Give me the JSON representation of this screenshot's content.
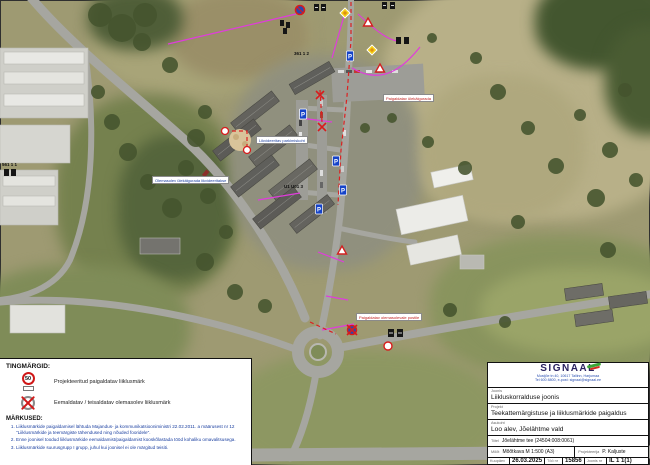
{
  "legend": {
    "heading": "TINGMÄRGID:",
    "items": [
      {
        "icon": "speed-limit-50-sign-icon",
        "sign_value": "50",
        "label": "Projekteeritud paigaldatav liiklusmärk"
      },
      {
        "icon": "removed-sign-icon",
        "label": "Eemaldatav / teisaldatav olemasolev liiklusmärk"
      }
    ],
    "notes_heading": "MÄRKUSED:",
    "notes": [
      "Liiklusmärkide paigaldamisel lähtuda Majandus- ja kommunikatsiooniministri 22.02.2011. a määrusest nr 12 \"Liiklusmärkide ja teemärgiste tähendused ning nõuded fooridele\".",
      "Enne joonisel toodud liiklusmärkide eemaldamist/paigaldamist kooskõlastada tööd kohaliku omavalitsusega.",
      "Liiklusmärkide suurusgrupp I grupp, juhul kui joonisel ei ole märgitud teisiti."
    ]
  },
  "title_block": {
    "company_name": "SIGNAAL",
    "company_address": "Mustjõe tn 40, 10617 Tallinn, Harjumaa",
    "company_contact": "Tel 600 8800, e-post: signaal@signaal.ee",
    "rows": [
      {
        "label": "Joonis",
        "value": "Liikluskorralduse joonis"
      },
      {
        "label": "Projekt",
        "value": "Teekattemärgistuse ja liiklusmärkide paigaldus"
      },
      {
        "label": "Asukoht",
        "value": "Loo alev, Jõelähtme vald"
      }
    ],
    "title_row": {
      "label": "Tiitel",
      "value": "Jõelähtme tee (24504:008:0061)"
    },
    "scale_row": {
      "label": "Mõõt",
      "value": "Mõõtkava M 1:500 (A3)"
    },
    "designer_row": {
      "label": "Projekteerija",
      "value": "P. Kaljuste"
    },
    "footer": {
      "date_label": "Kuupäev",
      "date_value": "26.03.2025",
      "work_label": "Töö nr",
      "work_value": "15856",
      "sheet_label": "Joonis nr",
      "sheet_value": "IL 1 1(1)"
    }
  },
  "map": {
    "labels": [
      {
        "text": "Olemasolev ülekäigurada likvideeritakse"
      },
      {
        "text": "Likvideeritav parkimiskoht"
      },
      {
        "text": "Paigaldatav ülekäigurada"
      },
      {
        "text": "Paigaldatav olemasolevale postile"
      }
    ],
    "sign_ids": [
      "561 1 1",
      "361 1 2",
      "U1 U01 3"
    ],
    "colors": {
      "annotation_magenta": "#e03cdc",
      "annotation_red": "#dc2020",
      "parking_sign_blue": "#1543c8",
      "notes_blue": "#1a3fa0"
    }
  }
}
